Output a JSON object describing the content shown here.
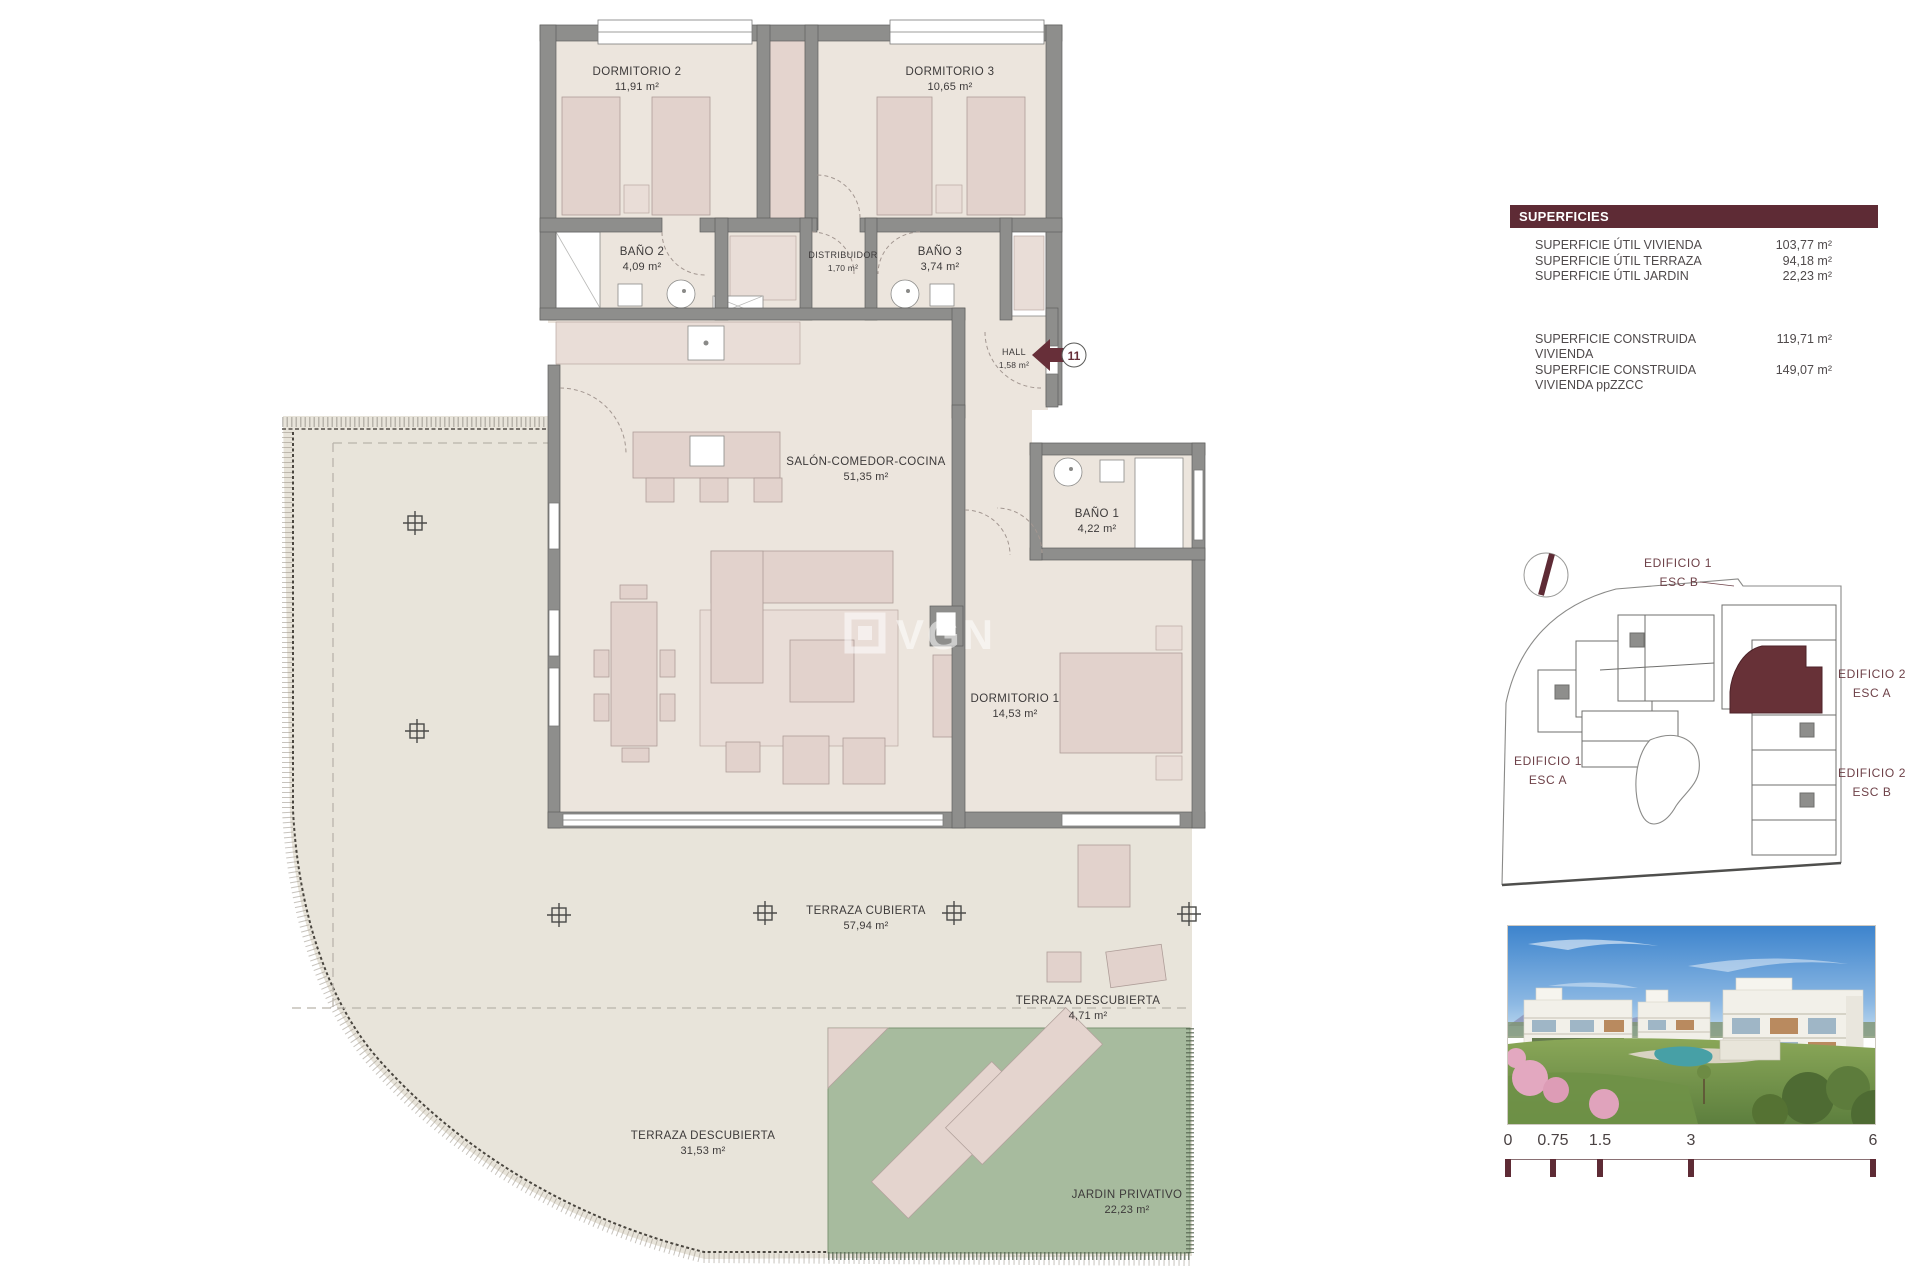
{
  "colors": {
    "accent_maroon": "#5e2b35",
    "wall_grey": "#8e8e8c",
    "interior_beige": "#ece5dd",
    "terrace_beige": "#e8e4da",
    "furniture_pink": "#e2d2cc",
    "garden_green": "#a7bb9e"
  },
  "plan": {
    "watermark": "VGN",
    "unit_marker": "11",
    "rooms": [
      {
        "name": "DORMITORIO 2",
        "area": "11,91 m²"
      },
      {
        "name": "DORMITORIO 3",
        "area": "10,65 m²"
      },
      {
        "name": "BAÑO 2",
        "area": "4,09 m²"
      },
      {
        "name": "DISTRIBUIDOR",
        "area": "1,70 m²"
      },
      {
        "name": "BAÑO 3",
        "area": "3,74 m²"
      },
      {
        "name": "HALL",
        "area": "1,58 m²"
      },
      {
        "name": "SALÓN-COMEDOR-COCINA",
        "area": "51,35 m²"
      },
      {
        "name": "BAÑO 1",
        "area": "4,22 m²"
      },
      {
        "name": "DORMITORIO 1",
        "area": "14,53 m²"
      },
      {
        "name": "TERRAZA CUBIERTA",
        "area": "57,94 m²"
      },
      {
        "name": "TERRAZA DESCUBIERTA",
        "area": "4,71 m²"
      },
      {
        "name": "TERRAZA DESCUBIERTA",
        "area": "31,53 m²"
      },
      {
        "name": "JARDIN PRIVATIVO",
        "area": "22,23 m²"
      }
    ]
  },
  "superficies": {
    "title": "SUPERFICIES",
    "util_rows": [
      {
        "label": "SUPERFICIE ÚTIL VIVIENDA",
        "value": "103,77 m²"
      },
      {
        "label": "SUPERFICIE ÚTIL TERRAZA",
        "value": "94,18 m²"
      },
      {
        "label": "SUPERFICIE ÚTIL JARDIN",
        "value": "22,23 m²"
      }
    ],
    "construida_rows": [
      {
        "label": "SUPERFICIE CONSTRUIDA VIVIENDA",
        "value": "119,71 m²"
      },
      {
        "label": "SUPERFICIE CONSTRUIDA VIVIENDA ppZZCC",
        "value": "149,07 m²"
      }
    ]
  },
  "site_plan": {
    "labels": [
      {
        "building": "EDIFICIO 1",
        "stair": "ESC B"
      },
      {
        "building": "EDIFICIO 2",
        "stair": "ESC A"
      },
      {
        "building": "EDIFICIO 1",
        "stair": "ESC A"
      },
      {
        "building": "EDIFICIO 2",
        "stair": "ESC B"
      }
    ]
  },
  "scale_bar": {
    "ticks": [
      "0",
      "0.75",
      "1.5",
      "3",
      "6"
    ]
  }
}
